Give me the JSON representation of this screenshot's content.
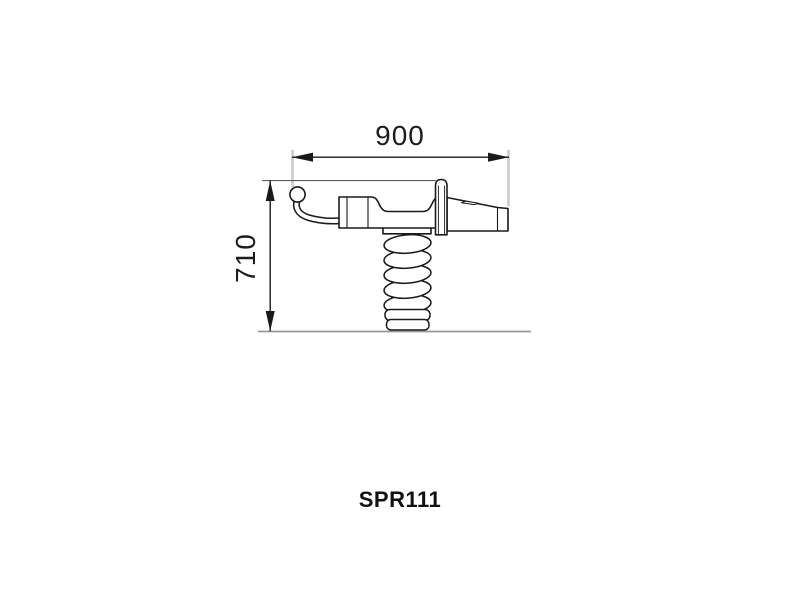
{
  "product": {
    "code": "SPR111"
  },
  "dimensions": {
    "width": {
      "label": "900"
    },
    "height": {
      "label": "710"
    }
  },
  "drawing": {
    "subject": "spring-rider-side-view",
    "parts": [
      "handlebar-knob",
      "handlebar",
      "seat-body",
      "backrest-post",
      "tail",
      "coil-spring",
      "ground-line"
    ]
  },
  "colors": {
    "background": "#ffffff",
    "outline": "#1a1a1a",
    "extension_line": "#cccccc",
    "ground_line": "#999999",
    "text": "#1c1c1c"
  }
}
